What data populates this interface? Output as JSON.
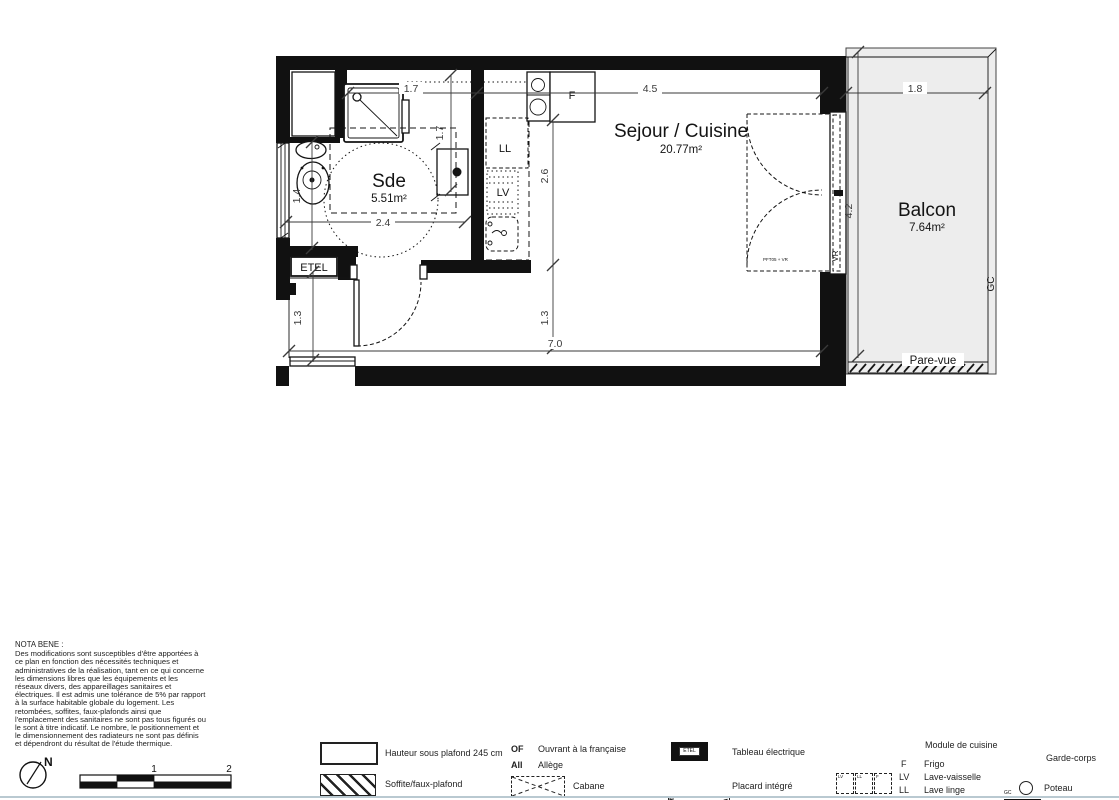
{
  "plan": {
    "rooms": {
      "sde": {
        "name": "Sde",
        "area": "5.51m²"
      },
      "sejour": {
        "name": "Sejour / Cuisine",
        "area": "20.77m²"
      },
      "balcon": {
        "name": "Balcon",
        "area": "7.64m²"
      }
    },
    "dims": {
      "d17_top": "1.7",
      "d45": "4.5",
      "d18": "1.8",
      "d17_v": "1.7",
      "d26": "2.6",
      "d14": "1.4",
      "d24": "2.4",
      "d42": "4.2",
      "d13_left": "1.3",
      "d13_mid": "1.3",
      "d70": "7.0"
    },
    "tags": {
      "ll": "LL",
      "lv": "LV",
      "f": "F",
      "etel": "ETEL",
      "vr": "VR",
      "pft": "PFT05 + VR",
      "gc": "GC",
      "pare_vue": "Pare-vue"
    }
  },
  "nota_bene": {
    "title": "NOTA BENE :",
    "body": "Des modifications sont susceptibles d'être apportées à\nce plan en fonction des nécessités techniques et\nadministratives de la réalisation, tant en ce qui concerne\nles dimensions libres que les équipements et les\nréseaux divers, des appareillages sanitaires et\nélectriques. Il est admis une tolérance de 5% par rapport\nà la surface habitable globale du logement. Les\nretombées, soffites, faux-plafonds ainsi que\nl'emplacement des sanitaires ne sont pas tous figurés ou\nle sont à titre indicatif. Le nombre, le positionnement et\nle dimensionnement des radiateurs ne sont pas définis\net dépendront du résultat de l'étude thermique."
  },
  "compass": {
    "north": "N"
  },
  "scale_bar": {
    "mid": "1",
    "end": "2"
  },
  "legend": {
    "ceiling_label": "Hauteur sous plafond 245 cm",
    "soffit_label": "Soffite/faux-plafond",
    "of_abbr": "OF",
    "of_label": "Ouvrant à la française",
    "all_abbr": "All",
    "all_label": "Allège",
    "cabane_label": "Cabane",
    "etel_symbol": "ETEL",
    "tableau_label": "Tableau électrique",
    "pi_abbr": "PI",
    "placard_label": "Placard intégré",
    "module_header": "Module de cuisine",
    "module_items": [
      {
        "abbr": "F",
        "label": "Frigo"
      },
      {
        "abbr": "LV",
        "label": "Lave-vaisselle"
      },
      {
        "abbr": "LL",
        "label": "Lave linge"
      }
    ],
    "module_boxes": [
      "LV",
      "LL",
      "F"
    ],
    "gc_abbr": "GC",
    "garde_corps_label": "Garde-corps",
    "poteau_label": "Poteau"
  },
  "colors": {
    "ink": "#141414",
    "balcony_fill": "#ededed",
    "divider": "#b9c9d1"
  }
}
